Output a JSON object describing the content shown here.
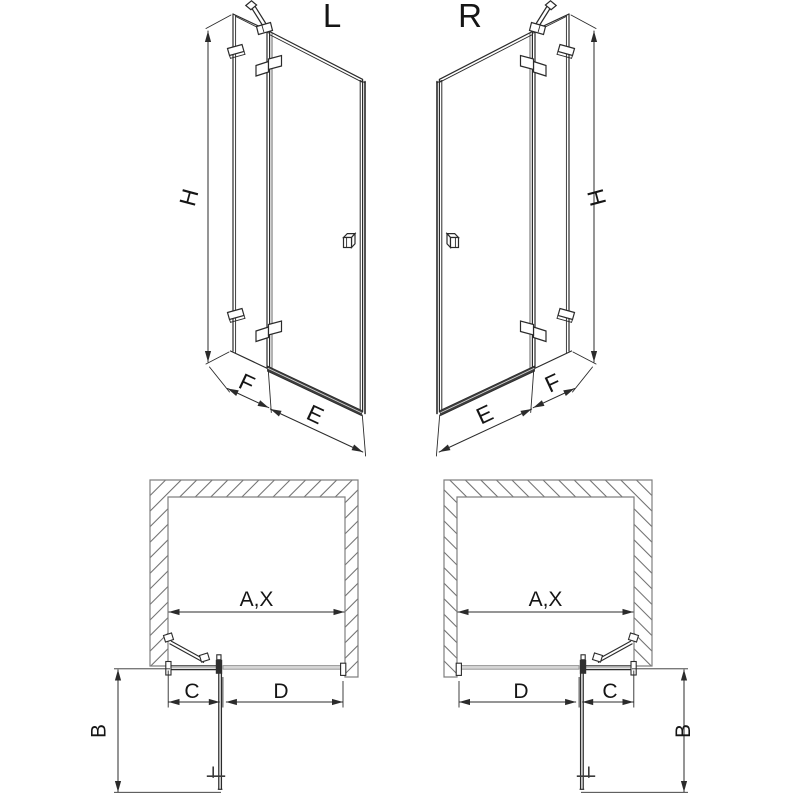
{
  "figure": {
    "left_variant": {
      "title": "L",
      "iso": {
        "height": "H",
        "fixed_panel_width": "F",
        "door_width": "E"
      },
      "plan": {
        "opening_width": "A,X",
        "fixed_section": "C",
        "door_section": "D",
        "door_projection": "B"
      }
    },
    "right_variant": {
      "title": "R",
      "iso": {
        "height": "H",
        "fixed_panel_width": "F",
        "door_width": "E"
      },
      "plan": {
        "opening_width": "A,X",
        "fixed_section": "C",
        "door_section": "D",
        "door_projection": "B"
      }
    }
  },
  "colors": {
    "line": "#2b2b2b",
    "light_line": "#c0c0c0",
    "wall_outline": "#808080",
    "hatch": "#6f6f6f",
    "threshold_fill": "#3d3d3d",
    "closed_door_fill": "#d6d6d6",
    "text": "#151515",
    "background": "#ffffff"
  }
}
